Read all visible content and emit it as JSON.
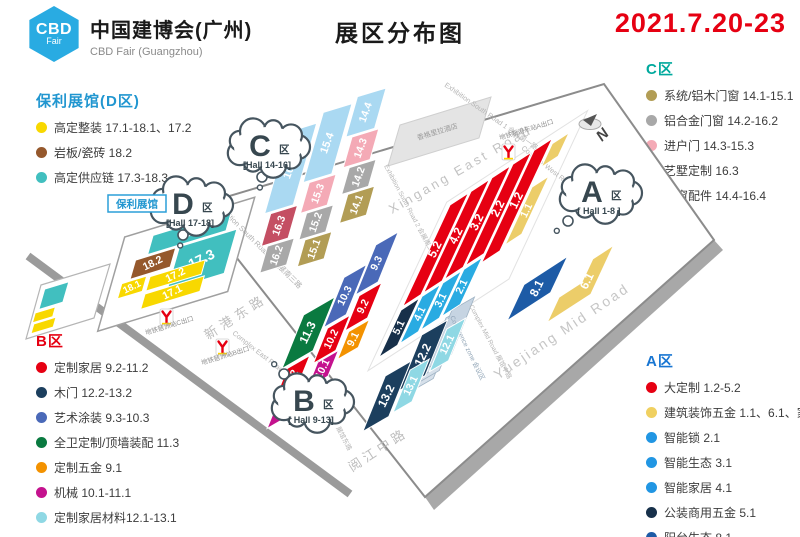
{
  "header": {
    "logo_line1": "CBD",
    "logo_line2": "Fair",
    "brand_cn": "中国建博会(广州)",
    "brand_en": "CBD Fair (Guangzhou)",
    "title": "展区分布图",
    "date": "2021.7.20-23"
  },
  "legends": {
    "d": {
      "title": "保利展馆(D区)",
      "title_color": "#2196d0",
      "items": [
        {
          "dot": "#f8d800",
          "label": "高定整装 17.1-18.1、17.2"
        },
        {
          "dot": "#95582c",
          "label": "岩板/瓷砖 18.2"
        },
        {
          "dot": "#41bfbf",
          "label": "高定供应链 17.3-18.3"
        }
      ]
    },
    "c": {
      "title": "C区",
      "title_color": "#00a99d",
      "items": [
        {
          "dot": "#b29d55",
          "label": "系统/铝木门窗 14.1-15.1"
        },
        {
          "dot": "#a8a8a8",
          "label": "铝合金门窗 14.2-16.2"
        },
        {
          "dot": "#f4aab6",
          "label": "进户门 14.3-15.3"
        },
        {
          "dot": "#c44f63",
          "label": "艺墅定制 16.3"
        },
        {
          "dot": "#8fc9f0",
          "label": "门窗配件 14.4-16.4"
        }
      ]
    },
    "b": {
      "title": "B区",
      "title_color": "#e60012",
      "items": [
        {
          "dot": "#e60012",
          "label": "定制家居 9.2-11.2"
        },
        {
          "dot": "#1c3f5e",
          "label": "木门 12.2-13.2"
        },
        {
          "dot": "#4a69b8",
          "label": "艺术涂装 9.3-10.3"
        },
        {
          "dot": "#0a7a40",
          "label": "全卫定制/顶墙装配 11.3"
        },
        {
          "dot": "#f39200",
          "label": "定制五金 9.1"
        },
        {
          "dot": "#c4128e",
          "label": "机械 10.1-11.1"
        },
        {
          "dot": "#8fd8e4",
          "label": "定制家居材料12.1-13.1"
        }
      ]
    },
    "a": {
      "title": "A区",
      "title_color": "#1976d2",
      "items": [
        {
          "dot": "#e60012",
          "label": "大定制 1.2-5.2"
        },
        {
          "dot": "#f0d060",
          "label": "建筑装饰五金 1.1、6.1、家居精品廊"
        },
        {
          "dot": "#2196e3",
          "label": "智能锁 2.1"
        },
        {
          "dot": "#2196e3",
          "label": "智能生态 3.1"
        },
        {
          "dot": "#2196e3",
          "label": "智能家居 4.1"
        },
        {
          "dot": "#17304a",
          "label": "公装商用五金 5.1"
        },
        {
          "dot": "#1d5ba6",
          "label": "阳台生态 8.1"
        }
      ]
    }
  },
  "map": {
    "palette": {
      "red": "#e60012",
      "lblue": "#29abe2",
      "navy": "#17304a",
      "blue8": "#1d5ba6",
      "gold": "#eccd69",
      "b_royal": "#4a69b8",
      "b_green": "#0a7a40",
      "b_orange": "#f39200",
      "b_magenta": "#c4128e",
      "b_navy": "#1c3f5e",
      "b_cyan": "#8fd8e4",
      "c_lblue": "#aad9f2",
      "c_pink": "#f4aab6",
      "c_gray": "#a8a8a8",
      "c_olive": "#b29d55",
      "c_rose": "#c44f63",
      "d_teal": "#41bfbf",
      "d_brown": "#95582c",
      "d_yellow": "#f8d800"
    },
    "halls": [
      {
        "id": "5.2",
        "color": "red"
      },
      {
        "id": "4.2",
        "color": "red"
      },
      {
        "id": "3.2",
        "color": "red"
      },
      {
        "id": "2.2",
        "color": "red"
      },
      {
        "id": "1.2",
        "color": "red"
      },
      {
        "id": "5.1",
        "color": "navy"
      },
      {
        "id": "4.1",
        "color": "lblue"
      },
      {
        "id": "3.1",
        "color": "lblue"
      },
      {
        "id": "2.1",
        "color": "lblue"
      },
      {
        "id": "1.1",
        "color": "gold"
      },
      {
        "id": "1.1b",
        "color": "gold"
      },
      {
        "id": "8.1",
        "color": "blue8"
      },
      {
        "id": "6.1",
        "color": "gold"
      },
      {
        "id": "9.3",
        "color": "b_royal"
      },
      {
        "id": "10.3",
        "color": "b_royal"
      },
      {
        "id": "11.3",
        "color": "b_green"
      },
      {
        "id": "9.2",
        "color": "red"
      },
      {
        "id": "10.2",
        "color": "red"
      },
      {
        "id": "11.2",
        "color": "red"
      },
      {
        "id": "9.1",
        "color": "b_orange"
      },
      {
        "id": "10.1",
        "color": "b_magenta"
      },
      {
        "id": "11.1",
        "color": "b_magenta"
      },
      {
        "id": "12.2",
        "color": "b_navy"
      },
      {
        "id": "13.2",
        "color": "b_navy"
      },
      {
        "id": "12.1",
        "color": "b_cyan"
      },
      {
        "id": "13.1",
        "color": "b_cyan"
      },
      {
        "id": "16.4",
        "color": "c_lblue"
      },
      {
        "id": "16.3",
        "color": "c_rose"
      },
      {
        "id": "16.2",
        "color": "c_gray"
      },
      {
        "id": "15.4",
        "color": "c_lblue"
      },
      {
        "id": "15.3",
        "color": "c_pink"
      },
      {
        "id": "15.2",
        "color": "c_gray"
      },
      {
        "id": "15.1",
        "color": "c_olive"
      },
      {
        "id": "14.4",
        "color": "c_lblue"
      },
      {
        "id": "14.3",
        "color": "c_pink"
      },
      {
        "id": "14.2",
        "color": "c_gray"
      },
      {
        "id": "14.1",
        "color": "c_olive"
      },
      {
        "id": "18.3",
        "color": "d_teal"
      },
      {
        "id": "18.2",
        "color": "d_brown"
      },
      {
        "id": "17.3",
        "color": "d_teal"
      },
      {
        "id": "18.1",
        "color": "d_yellow"
      },
      {
        "id": "17.2",
        "color": "d_yellow"
      },
      {
        "id": "17.1",
        "color": "d_yellow"
      }
    ],
    "clouds": {
      "A": {
        "letter": "A",
        "zone_char": "区",
        "range": "[ Hall 1-8 ]"
      },
      "B": {
        "letter": "B",
        "zone_char": "区",
        "range": "[ Hall 9-13]"
      },
      "C": {
        "letter": "C",
        "zone_char": "区",
        "range": "[Hall 14-16]"
      },
      "D": {
        "letter": "D",
        "zone_char": "区",
        "range": "[Hall 17-18]"
      }
    },
    "poly_tag": "保利展馆",
    "roads": {
      "xingang_en": "Xingang East Road",
      "xingang_cn": "新港东路",
      "yuejiang_en": "Yuejiang Mid Road",
      "yuejiang_cn": "阅江中路",
      "exh1": "Exhibition South Road 1 会展南一路",
      "exh2": "Exhibition South Road 2 会展南二路",
      "exh3": "Exhibition South Road 3 会展南三路",
      "complex_west": "Complex West Road",
      "complex_mid": "Complex Mid Road 展馆中路",
      "complex_east": "Complex East Road",
      "complex_east2": "展馆东路"
    },
    "metro": {
      "m1": "地铁新港东站A出口",
      "m2": "地铁琶洲站C出口",
      "m3": "地铁琶洲站B出口"
    },
    "hotel_label": "香格里拉酒店",
    "conference_label": "Conference zone 会议区",
    "compass": "N"
  }
}
